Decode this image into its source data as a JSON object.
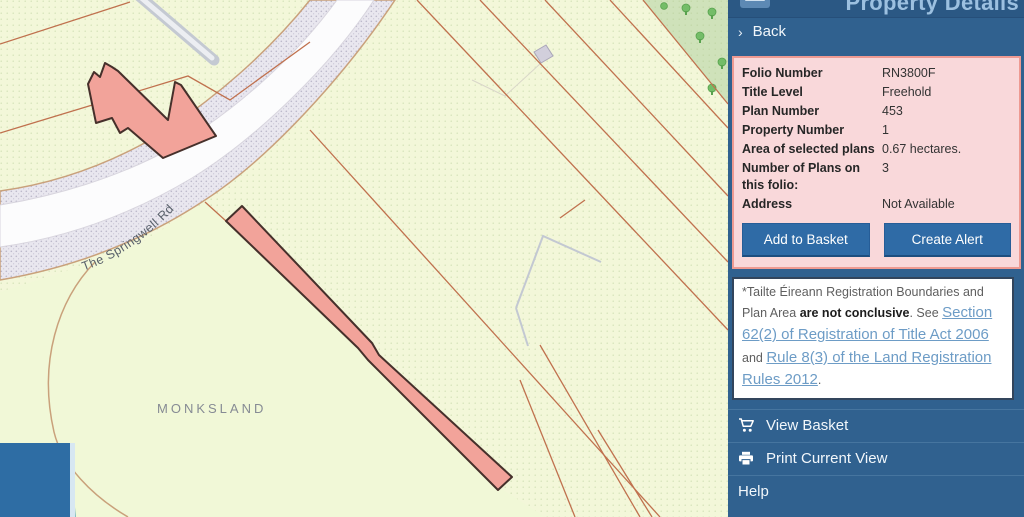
{
  "app": {
    "title": "Property Details"
  },
  "colors": {
    "sidebar_bg": "#30618f",
    "header_bg": "#2b5884",
    "panel_pink": "#f9d8da",
    "panel_border": "#ee9a92",
    "button_blue": "#2f6ba6",
    "link_blue": "#6d9cc6",
    "map_bg": "#f3f7d9",
    "parcel_line": "#c0714e",
    "highlight_parcel": "#f2a39a",
    "woodland": "#cfe2ba",
    "overview_square": "#2e6da4"
  },
  "sidebar": {
    "back_label": "Back",
    "back_chevron": "›",
    "details": {
      "rows": [
        {
          "label": "Folio Number",
          "value": "RN3800F"
        },
        {
          "label": "Title Level",
          "value": "Freehold"
        },
        {
          "label": "Plan Number",
          "value": "453"
        },
        {
          "label": "Property Number",
          "value": "1"
        },
        {
          "label": "Area of selected plans",
          "value": "0.67 hectares."
        },
        {
          "label": "Number of Plans on this folio:",
          "value": "3"
        },
        {
          "label": "Address",
          "value": "Not Available"
        }
      ],
      "buttons": {
        "add_to_basket": "Add to Basket",
        "create_alert": "Create Alert"
      }
    },
    "disclaimer": {
      "prefix": "*Tailte Éireann Registration Boundaries and Plan Area ",
      "bold": "are not conclusive",
      "mid": ". See ",
      "link1": "Section 62(2) of Registration of Title Act 2006",
      "and": " and ",
      "link2": "Rule 8(3) of the Land Registration Rules 2012",
      "suffix": "."
    },
    "menu": [
      {
        "label": "View Basket",
        "icon": "cart-icon"
      },
      {
        "label": "Print Current View",
        "icon": "printer-icon"
      },
      {
        "label": "Help",
        "icon": null
      }
    ]
  },
  "map": {
    "labels": {
      "townland": "MONKSLAND",
      "road": "The Springwell Rd"
    }
  }
}
